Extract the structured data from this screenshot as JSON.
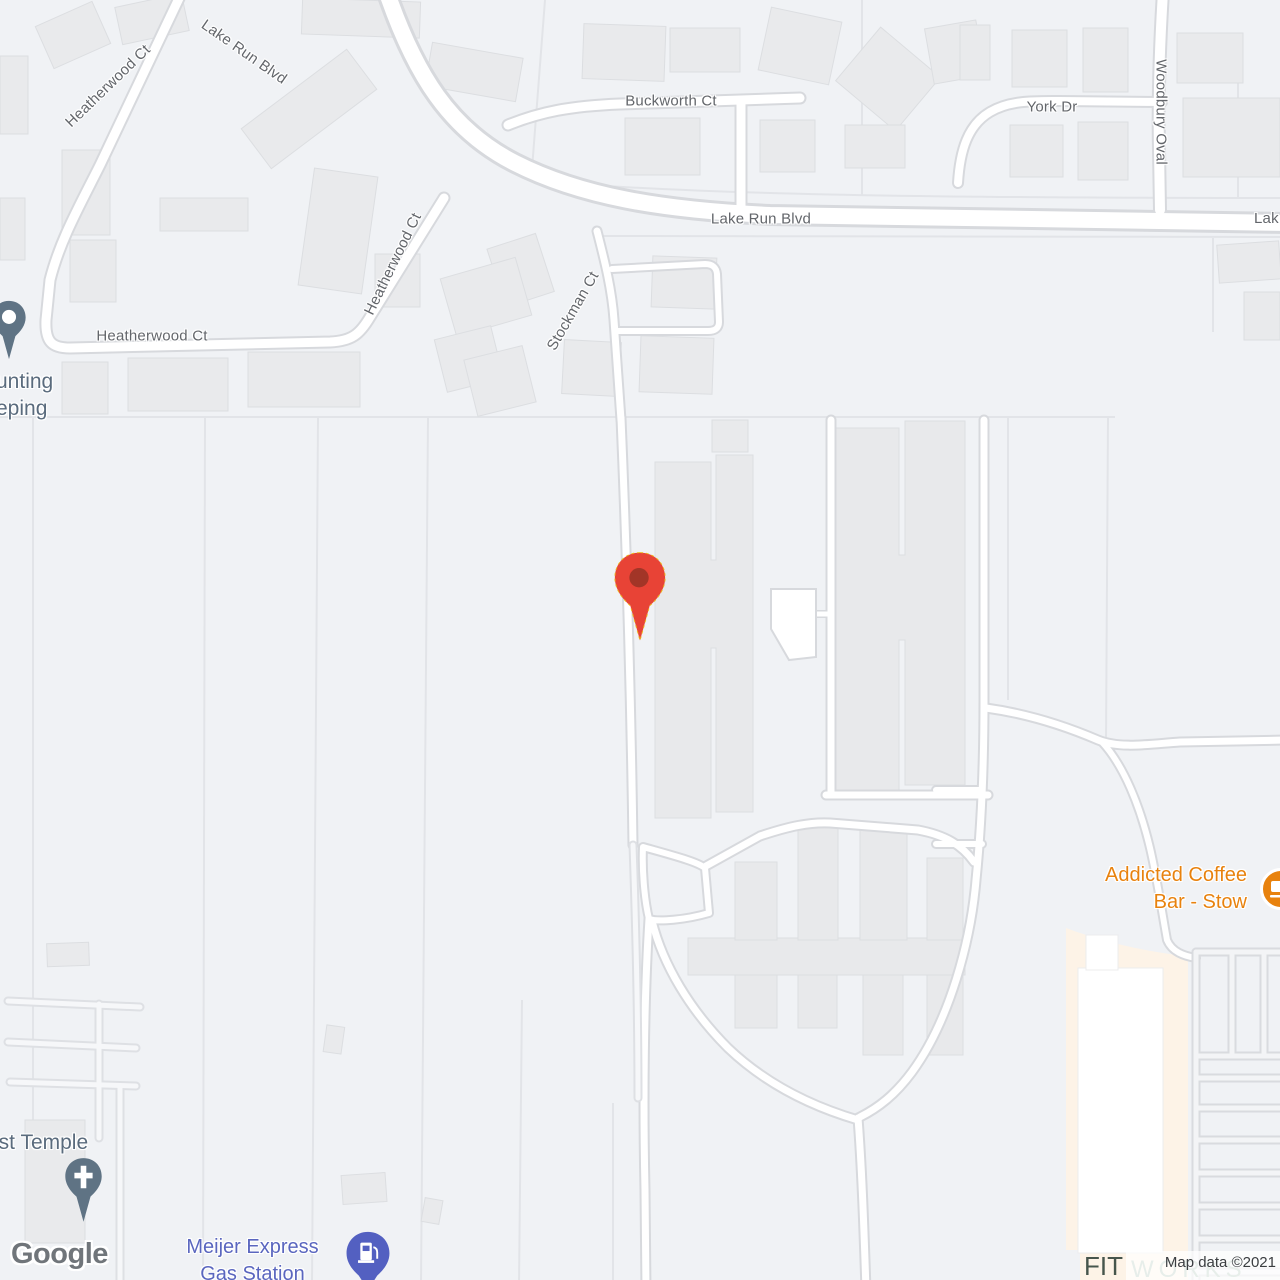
{
  "map": {
    "streets": {
      "heatherwood_nw": "Heatherwood Ct",
      "lake_run_diag": "Lake Run Blvd",
      "buckworth": "Buckworth Ct",
      "york": "York Dr",
      "woodbury": "Woodbury Oval",
      "lake_run_h": "Lake Run Blvd",
      "lake_run_clip": "Lak",
      "heatherwood_mid": "Heatherwood Ct",
      "heatherwood_h": "Heatherwood Ct",
      "stockman": "Stockman Ct"
    },
    "pois": {
      "accounting_line1": "unting",
      "accounting_line2": "eping",
      "coffee_line1": "Addicted Coffee",
      "coffee_line2": "Bar - Stow",
      "temple": "ist Temple",
      "meijer_line1": "Meijer Express",
      "meijer_line2": "Gas Station",
      "fitworks_fit": "FIT",
      "fitworks_works": "WORKS"
    },
    "attribution": {
      "logo": "Google",
      "map_data": "Map data ©2021"
    },
    "markers": {
      "main_pin": "red-location-pin",
      "coffee_icon": "cafe-circle-icon",
      "gas_icon": "gas-station-pin",
      "church_icon": "church-pin",
      "generic_icon": "business-pin"
    },
    "colors": {
      "background": "#f0f2f5",
      "road_fill": "#ffffff",
      "road_casing": "#d7d9dd",
      "building_fill": "#e9eaec",
      "commercial_fill": "#fdf3e7",
      "pin_red": "#e84336",
      "pin_red_dark": "#a23527",
      "coffee_orange": "#e8820e",
      "gas_indigo": "#5360c1",
      "church_slate": "#5f7384",
      "street_label": "#63666b",
      "poi_slate": "#5a6b7d",
      "fit_dark": "#46554c",
      "works_teal": "#a8c0b5"
    }
  }
}
